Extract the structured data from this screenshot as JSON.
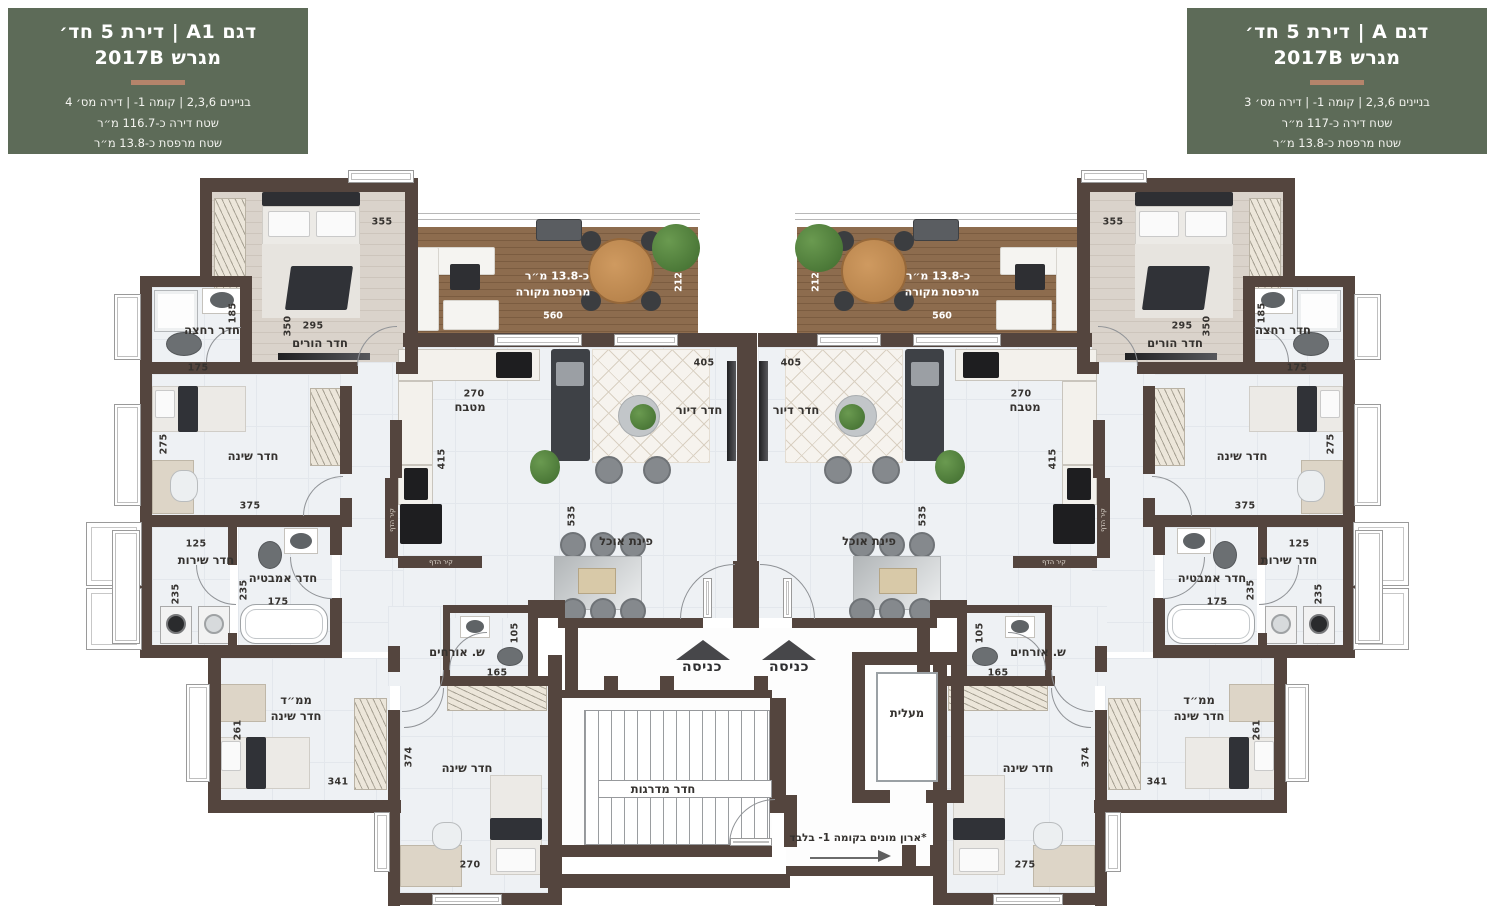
{
  "colors": {
    "header_bg": "#5d6b58",
    "header_divider": "#b5846b",
    "wall": "#54453e",
    "deck_wood": "#8a6a4c",
    "floor": "#eef1f4",
    "white_text": "#ffffff"
  },
  "header_left": {
    "title": "דגם A1 | דירת 5 חד׳",
    "subtitle": "מגרש 2017B",
    "line1": "בניינים 2,3,6 | קומה 1- | דירה מס׳ 4",
    "line2": "שטח דירה כ-116.7 מ״ר",
    "line3": "שטח מרפסת כ-13.8 מ״ר"
  },
  "header_right": {
    "title": "דגם A | דירת 5 חד׳",
    "subtitle": "מגרש 2017B",
    "line1": "בניינים 2,3,6 | קומה 1- | דירה מס׳ 3",
    "line2": "שטח דירה כ-117 מ״ר",
    "line3": "שטח מרפסת כ-13.8 מ״ר"
  },
  "plan": {
    "labels": [
      {
        "name": "balcony-left-area",
        "text": "כ-13.8 מ״ר",
        "x": 557,
        "y": 276,
        "s": "wroom"
      },
      {
        "name": "balcony-left-name",
        "text": "מרפסת מקורה",
        "x": 553,
        "y": 292,
        "s": "wroom"
      },
      {
        "name": "balcony-left-dim-560",
        "text": "560",
        "x": 553,
        "y": 316,
        "s": "wdim"
      },
      {
        "name": "balcony-left-dim-212",
        "text": "212",
        "x": 679,
        "y": 282,
        "s": "wdimv"
      },
      {
        "name": "parents-left-name",
        "text": "חדר הורים",
        "x": 320,
        "y": 343,
        "s": "room"
      },
      {
        "name": "parents-left-dim-295",
        "text": "295",
        "x": 313,
        "y": 326,
        "s": "dim"
      },
      {
        "name": "parents-left-dim-350",
        "text": "350",
        "x": 288,
        "y": 326,
        "s": "dimv"
      },
      {
        "name": "parents-left-dim-355",
        "text": "355",
        "x": 382,
        "y": 222,
        "s": "dim"
      },
      {
        "name": "bath-left-name",
        "text": "חדר רחצה",
        "x": 212,
        "y": 330,
        "s": "room"
      },
      {
        "name": "bath-left-dim-185",
        "text": "185",
        "x": 233,
        "y": 313,
        "s": "dimv"
      },
      {
        "name": "bath-left-dim-175",
        "text": "175",
        "x": 198,
        "y": 368,
        "s": "dim"
      },
      {
        "name": "bedroom1-left-name",
        "text": "חדר שינה",
        "x": 253,
        "y": 456,
        "s": "room"
      },
      {
        "name": "bedroom1-left-dim-275",
        "text": "275",
        "x": 164,
        "y": 444,
        "s": "dimv"
      },
      {
        "name": "bedroom1-left-dim-375",
        "text": "375",
        "x": 250,
        "y": 506,
        "s": "dim"
      },
      {
        "name": "service-left-dim-125",
        "text": "125",
        "x": 196,
        "y": 544,
        "s": "dim"
      },
      {
        "name": "service-left-name",
        "text": "חדר שירות",
        "x": 206,
        "y": 560,
        "s": "room"
      },
      {
        "name": "service-left-dim-235",
        "text": "235",
        "x": 176,
        "y": 594,
        "s": "dimv"
      },
      {
        "name": "bathtub-left-name",
        "text": "חדר אמבטיה",
        "x": 283,
        "y": 578,
        "s": "room"
      },
      {
        "name": "bathtub-left-dim-235",
        "text": "235",
        "x": 244,
        "y": 590,
        "s": "dimv"
      },
      {
        "name": "bathtub-left-dim-175",
        "text": "175",
        "x": 278,
        "y": 602,
        "s": "dim"
      },
      {
        "name": "mamad-left-name1",
        "text": "ממ״ד",
        "x": 296,
        "y": 700,
        "s": "room"
      },
      {
        "name": "mamad-left-name2",
        "text": "חדר שינה",
        "x": 296,
        "y": 716,
        "s": "room"
      },
      {
        "name": "mamad-left-dim-261",
        "text": "261",
        "x": 238,
        "y": 730,
        "s": "dimv"
      },
      {
        "name": "mamad-left-dim-341",
        "text": "341",
        "x": 338,
        "y": 782,
        "s": "dim"
      },
      {
        "name": "bedroom2-left-name",
        "text": "חדר שינה",
        "x": 467,
        "y": 768,
        "s": "room"
      },
      {
        "name": "bedroom2-left-dim-374",
        "text": "374",
        "x": 409,
        "y": 757,
        "s": "dimv"
      },
      {
        "name": "bedroom2-left-dim-270",
        "text": "270",
        "x": 470,
        "y": 865,
        "s": "dim"
      },
      {
        "name": "guest-wc-left-name",
        "text": "ש. אורחים",
        "x": 457,
        "y": 652,
        "s": "room"
      },
      {
        "name": "guest-wc-left-dim-165",
        "text": "165",
        "x": 497,
        "y": 673,
        "s": "dim"
      },
      {
        "name": "guest-wc-left-dim-105",
        "text": "105",
        "x": 515,
        "y": 633,
        "s": "dimv"
      },
      {
        "name": "kitchen-left-dim-270",
        "text": "270",
        "x": 474,
        "y": 394,
        "s": "dim"
      },
      {
        "name": "kitchen-left-name",
        "text": "מטבח",
        "x": 470,
        "y": 407,
        "s": "room"
      },
      {
        "name": "kitchen-left-dim-415",
        "text": "415",
        "x": 442,
        "y": 459,
        "s": "dimv"
      },
      {
        "name": "living-left-dim-405",
        "text": "405",
        "x": 704,
        "y": 363,
        "s": "dim"
      },
      {
        "name": "living-left-name",
        "text": "חדר דיור",
        "x": 699,
        "y": 410,
        "s": "room"
      },
      {
        "name": "dining-left-name",
        "text": "פינת אוכל",
        "x": 626,
        "y": 541,
        "s": "room"
      },
      {
        "name": "dining-left-dim-535",
        "text": "535",
        "x": 572,
        "y": 516,
        "s": "dimv"
      },
      {
        "name": "blast-wall-left-v",
        "text": "קיר הדף",
        "x": 392,
        "y": 520,
        "s": "tagv"
      },
      {
        "name": "blast-wall-left-h",
        "text": "קיר הדף",
        "x": 441,
        "y": 562,
        "s": "tag"
      },
      {
        "name": "balcony-right-area",
        "text": "כ-13.8 מ״ר",
        "x": 938,
        "y": 276,
        "s": "wroom"
      },
      {
        "name": "balcony-right-name",
        "text": "מרפסת מקורה",
        "x": 942,
        "y": 292,
        "s": "wroom"
      },
      {
        "name": "balcony-right-dim-560",
        "text": "560",
        "x": 942,
        "y": 316,
        "s": "wdim"
      },
      {
        "name": "balcony-right-dim-212",
        "text": "212",
        "x": 816,
        "y": 282,
        "s": "wdimv"
      },
      {
        "name": "parents-right-name",
        "text": "חדר הורים",
        "x": 1175,
        "y": 343,
        "s": "room"
      },
      {
        "name": "parents-right-dim-295",
        "text": "295",
        "x": 1182,
        "y": 326,
        "s": "dim"
      },
      {
        "name": "parents-right-dim-350",
        "text": "350",
        "x": 1207,
        "y": 326,
        "s": "dimv"
      },
      {
        "name": "parents-right-dim-355",
        "text": "355",
        "x": 1113,
        "y": 222,
        "s": "dim"
      },
      {
        "name": "bath-right-name",
        "text": "חדר רחצה",
        "x": 1283,
        "y": 330,
        "s": "room"
      },
      {
        "name": "bath-right-dim-185",
        "text": "185",
        "x": 1262,
        "y": 313,
        "s": "dimv"
      },
      {
        "name": "bath-right-dim-175",
        "text": "175",
        "x": 1297,
        "y": 368,
        "s": "dim"
      },
      {
        "name": "bedroom1-right-name",
        "text": "חדר שינה",
        "x": 1242,
        "y": 456,
        "s": "room"
      },
      {
        "name": "bedroom1-right-dim-275",
        "text": "275",
        "x": 1331,
        "y": 444,
        "s": "dimv"
      },
      {
        "name": "bedroom1-right-dim-375",
        "text": "375",
        "x": 1245,
        "y": 506,
        "s": "dim"
      },
      {
        "name": "service-right-dim-125",
        "text": "125",
        "x": 1299,
        "y": 544,
        "s": "dim"
      },
      {
        "name": "service-right-name",
        "text": "חדר שירות",
        "x": 1289,
        "y": 560,
        "s": "room"
      },
      {
        "name": "service-right-dim-235",
        "text": "235",
        "x": 1319,
        "y": 594,
        "s": "dimv"
      },
      {
        "name": "bathtub-right-name",
        "text": "חדר אמבטיה",
        "x": 1212,
        "y": 578,
        "s": "room"
      },
      {
        "name": "bathtub-right-dim-235",
        "text": "235",
        "x": 1251,
        "y": 590,
        "s": "dimv"
      },
      {
        "name": "bathtub-right-dim-175",
        "text": "175",
        "x": 1217,
        "y": 602,
        "s": "dim"
      },
      {
        "name": "mamad-right-name1",
        "text": "ממ״ד",
        "x": 1199,
        "y": 700,
        "s": "room"
      },
      {
        "name": "mamad-right-name2",
        "text": "חדר שינה",
        "x": 1199,
        "y": 716,
        "s": "room"
      },
      {
        "name": "mamad-right-dim-261",
        "text": "261",
        "x": 1257,
        "y": 730,
        "s": "dimv"
      },
      {
        "name": "mamad-right-dim-341",
        "text": "341",
        "x": 1157,
        "y": 782,
        "s": "dim"
      },
      {
        "name": "bedroom2-right-name",
        "text": "חדר שינה",
        "x": 1028,
        "y": 768,
        "s": "room"
      },
      {
        "name": "bedroom2-right-dim-374",
        "text": "374",
        "x": 1086,
        "y": 757,
        "s": "dimv"
      },
      {
        "name": "bedroom2-right-dim-275",
        "text": "275",
        "x": 1025,
        "y": 865,
        "s": "dim"
      },
      {
        "name": "guest-wc-right-name",
        "text": "ש. אורחים",
        "x": 1038,
        "y": 652,
        "s": "room"
      },
      {
        "name": "guest-wc-right-dim-165",
        "text": "165",
        "x": 998,
        "y": 673,
        "s": "dim"
      },
      {
        "name": "guest-wc-right-dim-105",
        "text": "105",
        "x": 980,
        "y": 633,
        "s": "dimv"
      },
      {
        "name": "kitchen-right-dim-270",
        "text": "270",
        "x": 1021,
        "y": 394,
        "s": "dim"
      },
      {
        "name": "kitchen-right-name",
        "text": "מטבח",
        "x": 1025,
        "y": 407,
        "s": "room"
      },
      {
        "name": "kitchen-right-dim-415",
        "text": "415",
        "x": 1053,
        "y": 459,
        "s": "dimv"
      },
      {
        "name": "living-right-dim-405",
        "text": "405",
        "x": 791,
        "y": 363,
        "s": "dim"
      },
      {
        "name": "living-right-name",
        "text": "חדר דיור",
        "x": 796,
        "y": 410,
        "s": "room"
      },
      {
        "name": "dining-right-name",
        "text": "פינת אוכל",
        "x": 869,
        "y": 541,
        "s": "room"
      },
      {
        "name": "dining-right-dim-535",
        "text": "535",
        "x": 923,
        "y": 516,
        "s": "dimv"
      },
      {
        "name": "blast-wall-right-v",
        "text": "קיר הדף",
        "x": 1103,
        "y": 520,
        "s": "tagv"
      },
      {
        "name": "blast-wall-right-h",
        "text": "קיר הדף",
        "x": 1054,
        "y": 562,
        "s": "tag"
      },
      {
        "name": "entrance-left-label",
        "text": "כניסה",
        "x": 702,
        "y": 667,
        "s": "big"
      },
      {
        "name": "entrance-right-label",
        "text": "כניסה",
        "x": 789,
        "y": 667,
        "s": "big"
      },
      {
        "name": "stairwell-label",
        "text": "חדר מדרגות",
        "x": 663,
        "y": 789,
        "s": "common"
      },
      {
        "name": "elevator-label",
        "text": "מעלית",
        "x": 907,
        "y": 713,
        "s": "common"
      },
      {
        "name": "meters-note",
        "text": "*ארון מונים בקומה 1- בלבד",
        "x": 858,
        "y": 838,
        "s": "note"
      }
    ]
  }
}
